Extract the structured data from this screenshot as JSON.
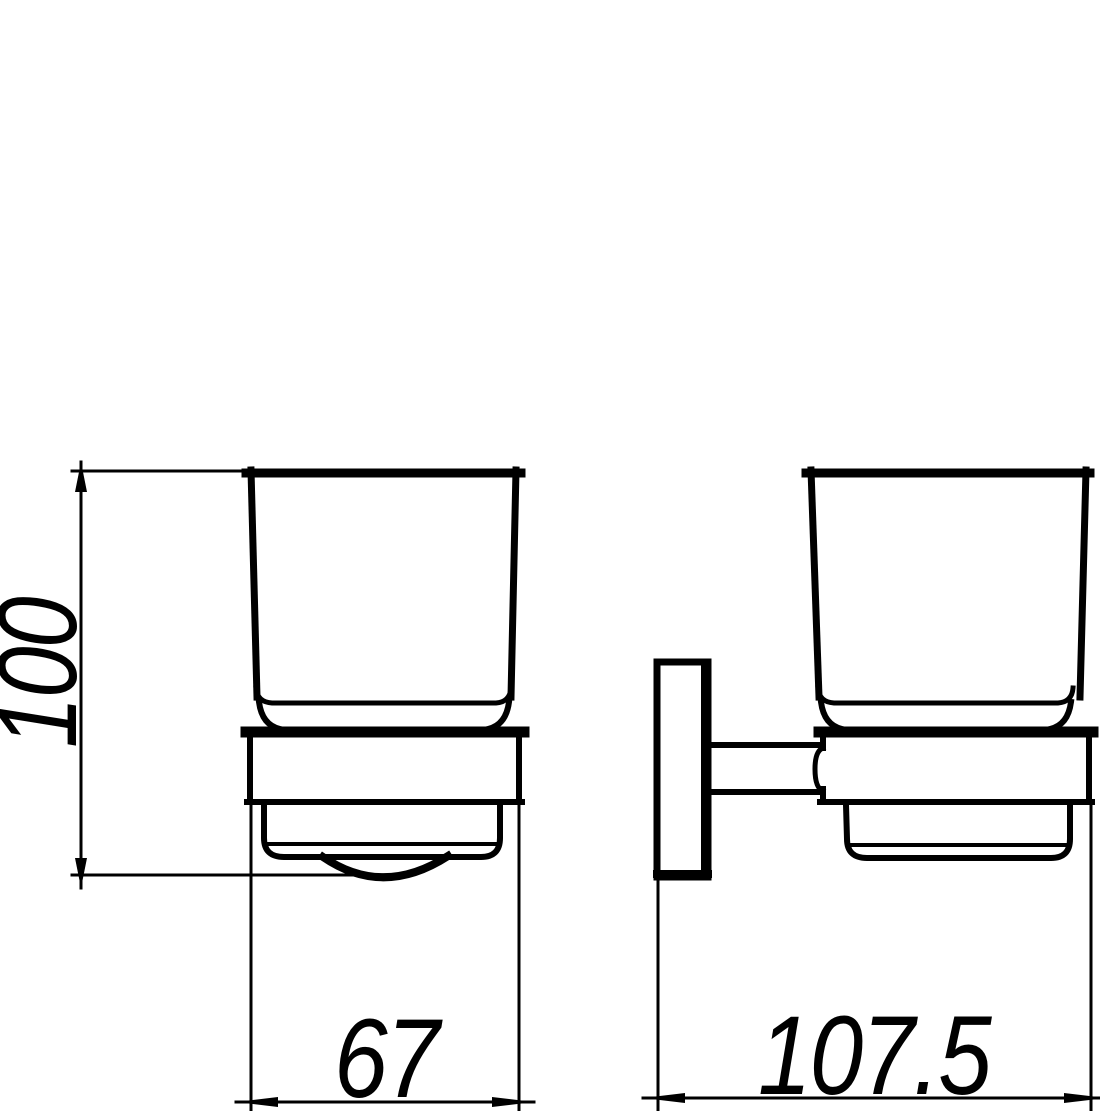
{
  "drawing": {
    "background_color": "#ffffff",
    "line_color": "#000000",
    "dimensions": {
      "height_mm": "100",
      "width_mm": "67",
      "depth_mm": "107.5"
    }
  }
}
